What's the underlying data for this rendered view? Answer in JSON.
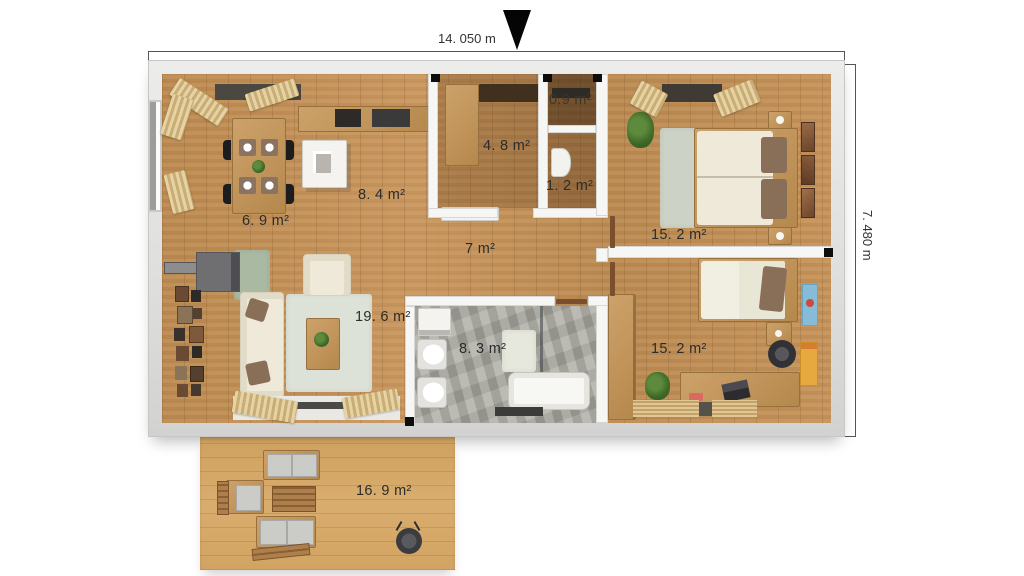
{
  "plan": {
    "type": "apartment-floor-plan-top-view",
    "dimensions": {
      "width_label": "14. 050 m",
      "height_label": "7. 480 m"
    },
    "rooms": [
      {
        "name": "dining-area",
        "area": "6. 9 m²"
      },
      {
        "name": "kitchen",
        "area": "8. 4 m²"
      },
      {
        "name": "entry-hall",
        "area": "4. 8 m²"
      },
      {
        "name": "storage",
        "area": "0.9 m²"
      },
      {
        "name": "wc",
        "area": "1. 2 m²"
      },
      {
        "name": "corridor",
        "area": "7 m²"
      },
      {
        "name": "bedroom-top",
        "area": "15. 2 m²"
      },
      {
        "name": "bedroom-bottom",
        "area": "15. 2 m²"
      },
      {
        "name": "living-room",
        "area": "19. 6 m²"
      },
      {
        "name": "bathroom",
        "area": "8. 3 m²"
      },
      {
        "name": "terrace",
        "area": "16. 9 m²"
      }
    ],
    "icons": {
      "north_arrow": "filled-down-triangle"
    },
    "colors": {
      "wall": "#e3e3e2",
      "interior_wall": "#f6f6f4",
      "floor_wood": "#c28f57",
      "terrace_wood": "#d3a667",
      "bathroom_tile": "#a9a8a0",
      "label_text": "#2c2c2c",
      "dimension_text": "#333333",
      "accent_dark": "#0d0d0d"
    }
  }
}
